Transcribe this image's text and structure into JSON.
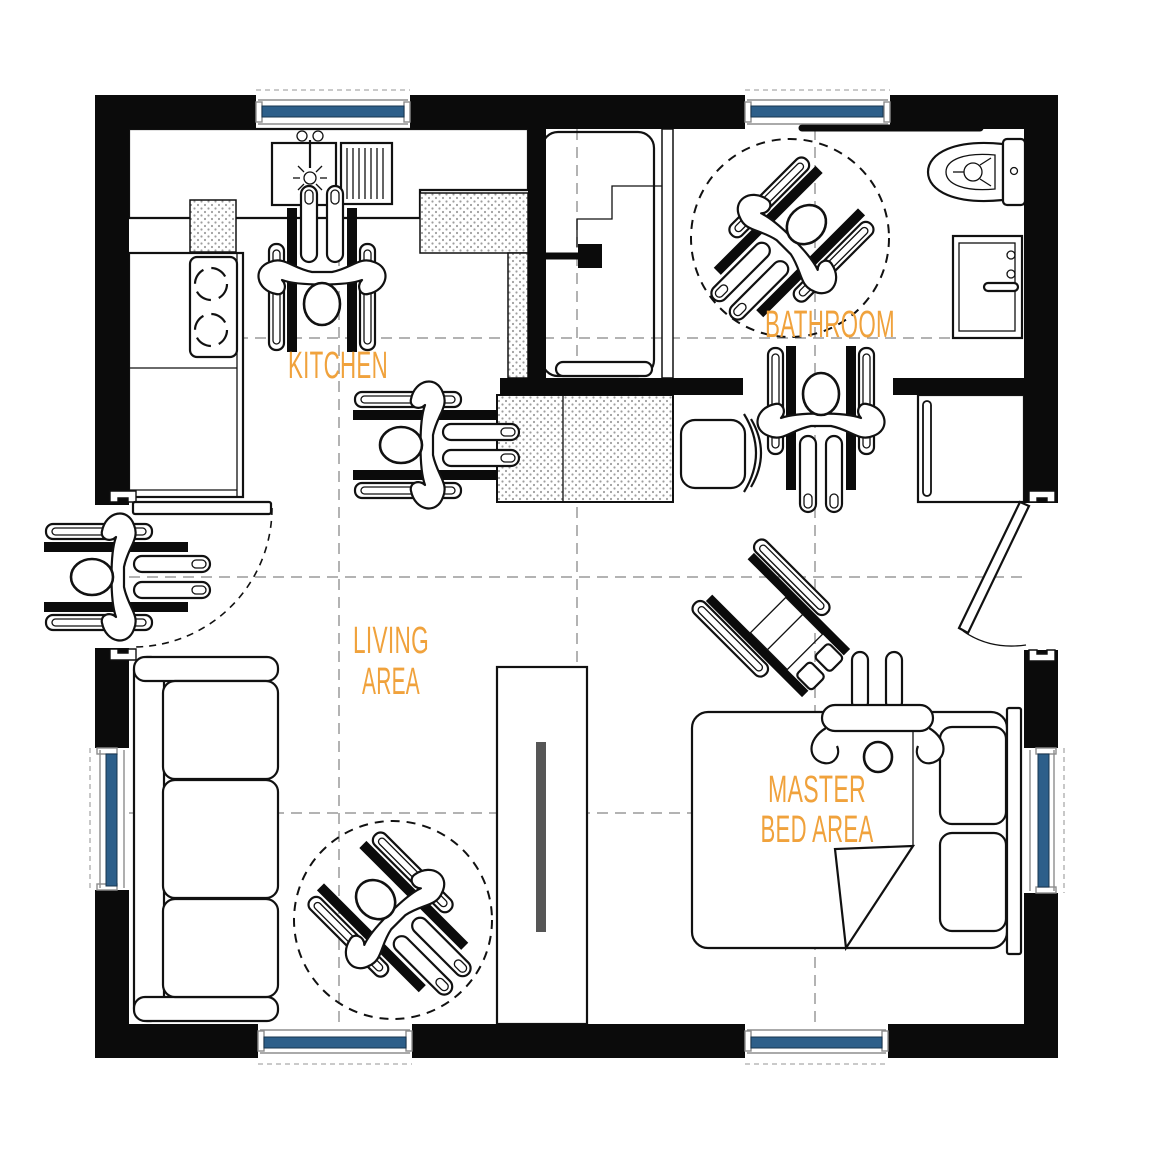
{
  "title": "Accessible studio apartment floor plan",
  "colors": {
    "wall": "#0b0b0b",
    "line": "#111111",
    "window_blue": "#2d5f8a",
    "label_orange": "#f0a23c",
    "grid_gray": "#9a9a9a",
    "tv_gray": "#565656",
    "hatch_dot": "#9e9e9e",
    "background": "#ffffff"
  },
  "labels": {
    "kitchen": "KITCHEN",
    "bathroom": "BATHROOM",
    "living_line1": "LIVING",
    "living_line2": "AREA",
    "master_line1": "MASTER",
    "master_line2": "BED AREA"
  },
  "icons": {
    "wheelchair_user": "top-view pictogram of a person in a wheelchair",
    "wheelchair_empty": "top-view pictogram of an empty wheelchair",
    "turning_circle": "dashed wheelchair turning-radius circle",
    "window": "blue double-line window symbol",
    "door_swing": "door leaf with swing arc",
    "sink": "kitchen sink with faucet and drain",
    "drying_rack": "counter drying rack",
    "stove": "two-burner stove",
    "toilet": "toilet with tank",
    "vanity": "bathroom vanity sink",
    "shower": "roll-in shower enclosure with bench and grab handle",
    "dining_table": "hatched dining table",
    "chair": "dining chair",
    "sofa": "three-seat sofa",
    "tv_cabinet": "media cabinet with TV",
    "bed": "double bed with pillows, folded blanket and resting person",
    "wardrobe": "wardrobe closet"
  }
}
